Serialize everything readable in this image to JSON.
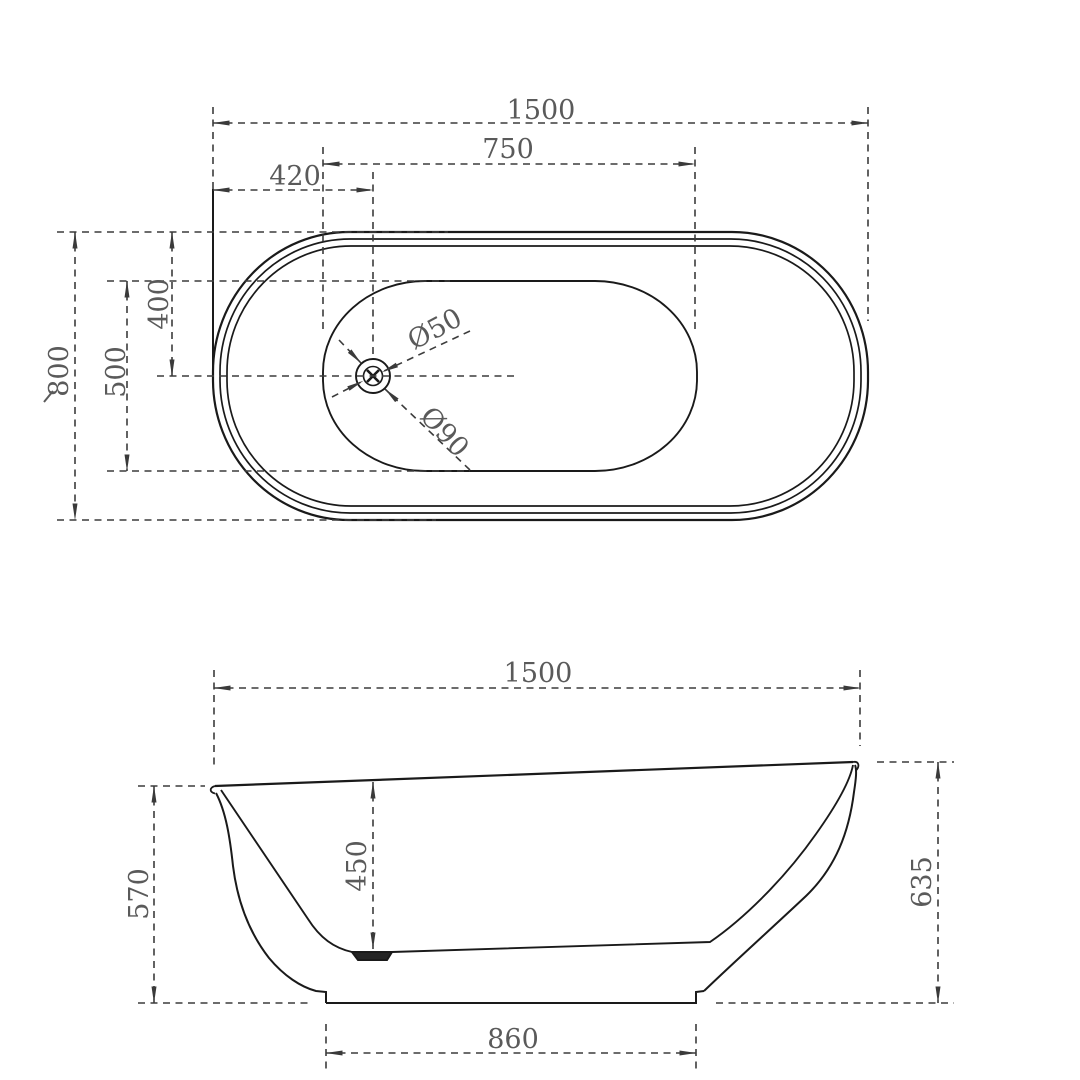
{
  "top_view": {
    "overall_length": "1500",
    "inner_length": "750",
    "drain_offset_x": "420",
    "overall_width": "800",
    "inner_width": "500",
    "drain_offset_y": "400",
    "drain_small_diameter": "Ø50",
    "drain_large_diameter": "Ø90"
  },
  "side_view": {
    "overall_length": "1500",
    "left_rim_height": "570",
    "inner_depth": "450",
    "right_rim_height": "635",
    "base_length": "860"
  },
  "colors": {
    "background": "#ffffff",
    "outline": "#1a1a1a",
    "dimension_lines": "#3c3c3c",
    "dimension_text": "#5a5a5a"
  }
}
